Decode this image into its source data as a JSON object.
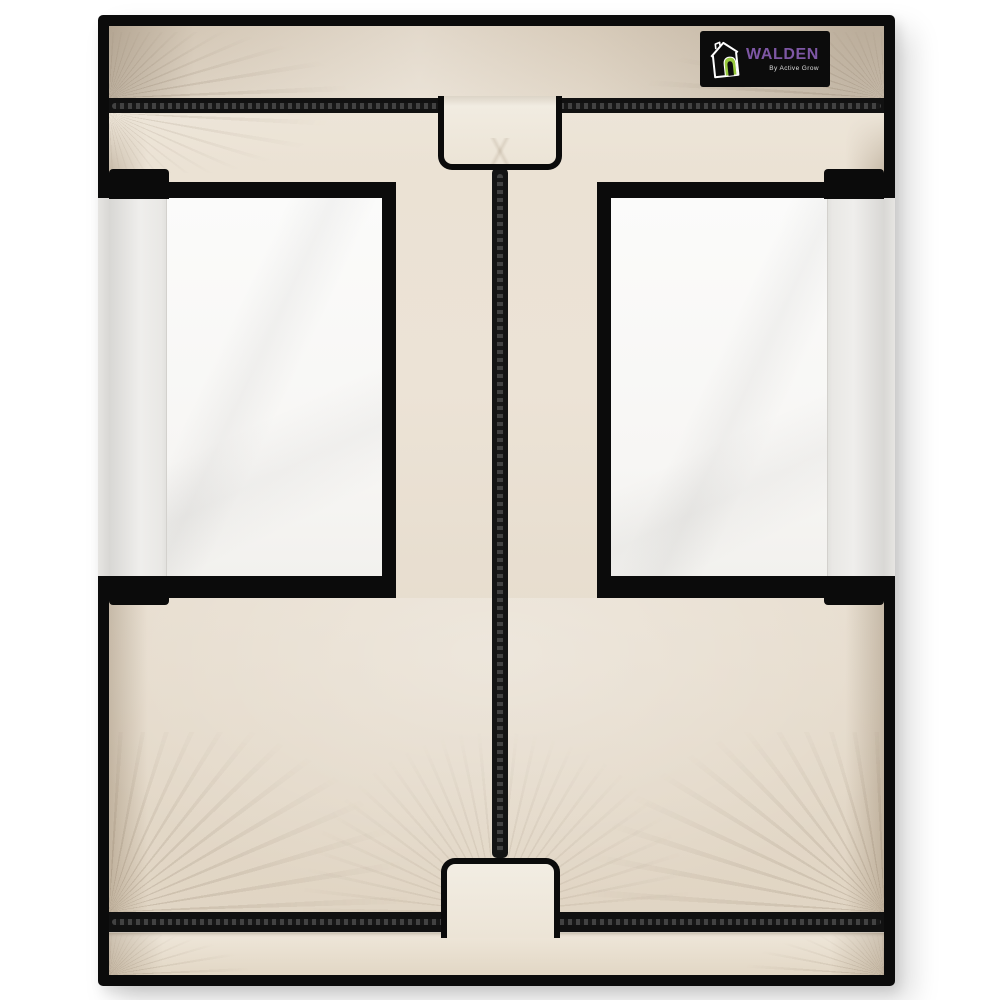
{
  "image": {
    "subject": "Grow tent front view product photo",
    "type": "product-photo"
  },
  "brand_badge": {
    "brand_name": "WALDEN",
    "tagline": "By Active Grow",
    "icon": "house-icon"
  },
  "colors": {
    "page_background": "#ffffff",
    "frame_black": "#0b0b0b",
    "fabric_beige": "#e7ddcf",
    "fabric_edge_shade": "#c9baa4",
    "window_white": "#fafaf9",
    "skirt_beige": "#e8dfd0",
    "flap_cream": "#f2ede3",
    "badge_background": "#0c0c0c",
    "brand_purple": "#7e57a5",
    "accent_green": "#97c93d"
  }
}
